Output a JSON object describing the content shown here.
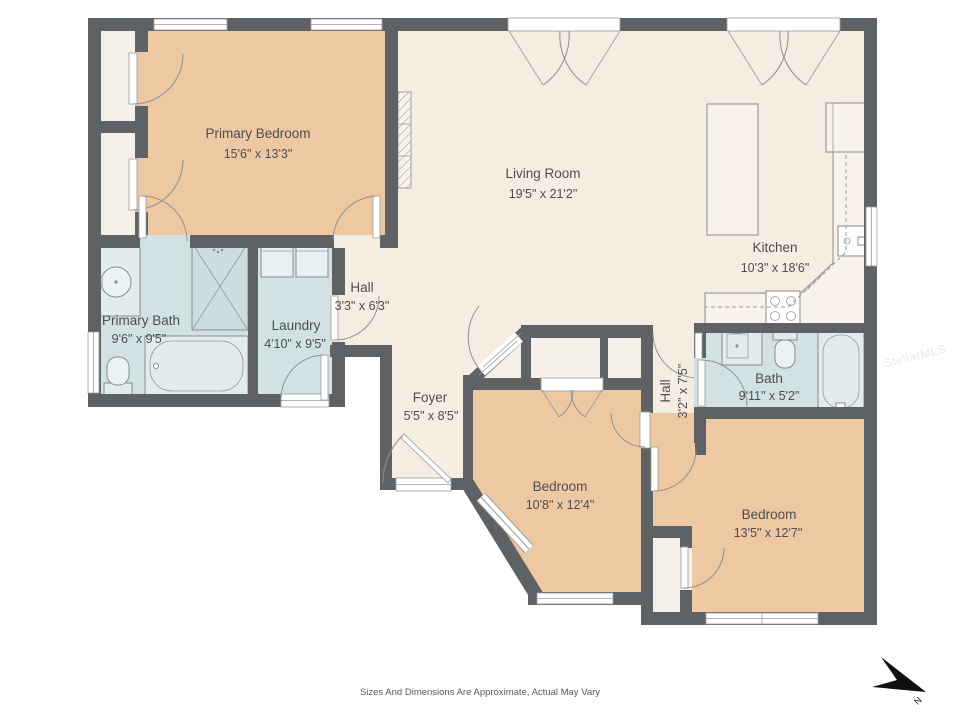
{
  "floor_plan": {
    "rooms": {
      "primary_bedroom": {
        "name": "Primary Bedroom",
        "dims": "15'6\" x 13'3\""
      },
      "living_room": {
        "name": "Living Room",
        "dims": "19'5\" x 21'2\""
      },
      "kitchen": {
        "name": "Kitchen",
        "dims": "10'3\" x 18'6\""
      },
      "hall": {
        "name": "Hall",
        "dims": "3'3\" x 6'3\""
      },
      "primary_bath": {
        "name": "Primary Bath",
        "dims": "9'6\" x 9'5\""
      },
      "laundry": {
        "name": "Laundry",
        "dims": "4'10\" x 9'5\""
      },
      "foyer": {
        "name": "Foyer",
        "dims": "5'5\" x 8'5\""
      },
      "hall_bedroom": {
        "name": "Hall",
        "dims": "3'2\" x 7'5\""
      },
      "bath": {
        "name": "Bath",
        "dims": "9'11\" x 5'2\""
      },
      "bedroom_front": {
        "name": "Bedroom",
        "dims": "10'8\" x 12'4\""
      },
      "bedroom_corner": {
        "name": "Bedroom",
        "dims": "13'5\" x 12'7\""
      }
    },
    "disclaimer": "Sizes And Dimensions Are Approximate, Actual May Vary",
    "watermark": "StellarMLS",
    "compass_label": "N",
    "colors": {
      "wall": "#5F6265",
      "floor_main": "#F5ECE2",
      "floor_bedroom": "#EDC8A2",
      "floor_wet": "#D2E2E4",
      "floor_closet": "#F5F0E9"
    }
  }
}
